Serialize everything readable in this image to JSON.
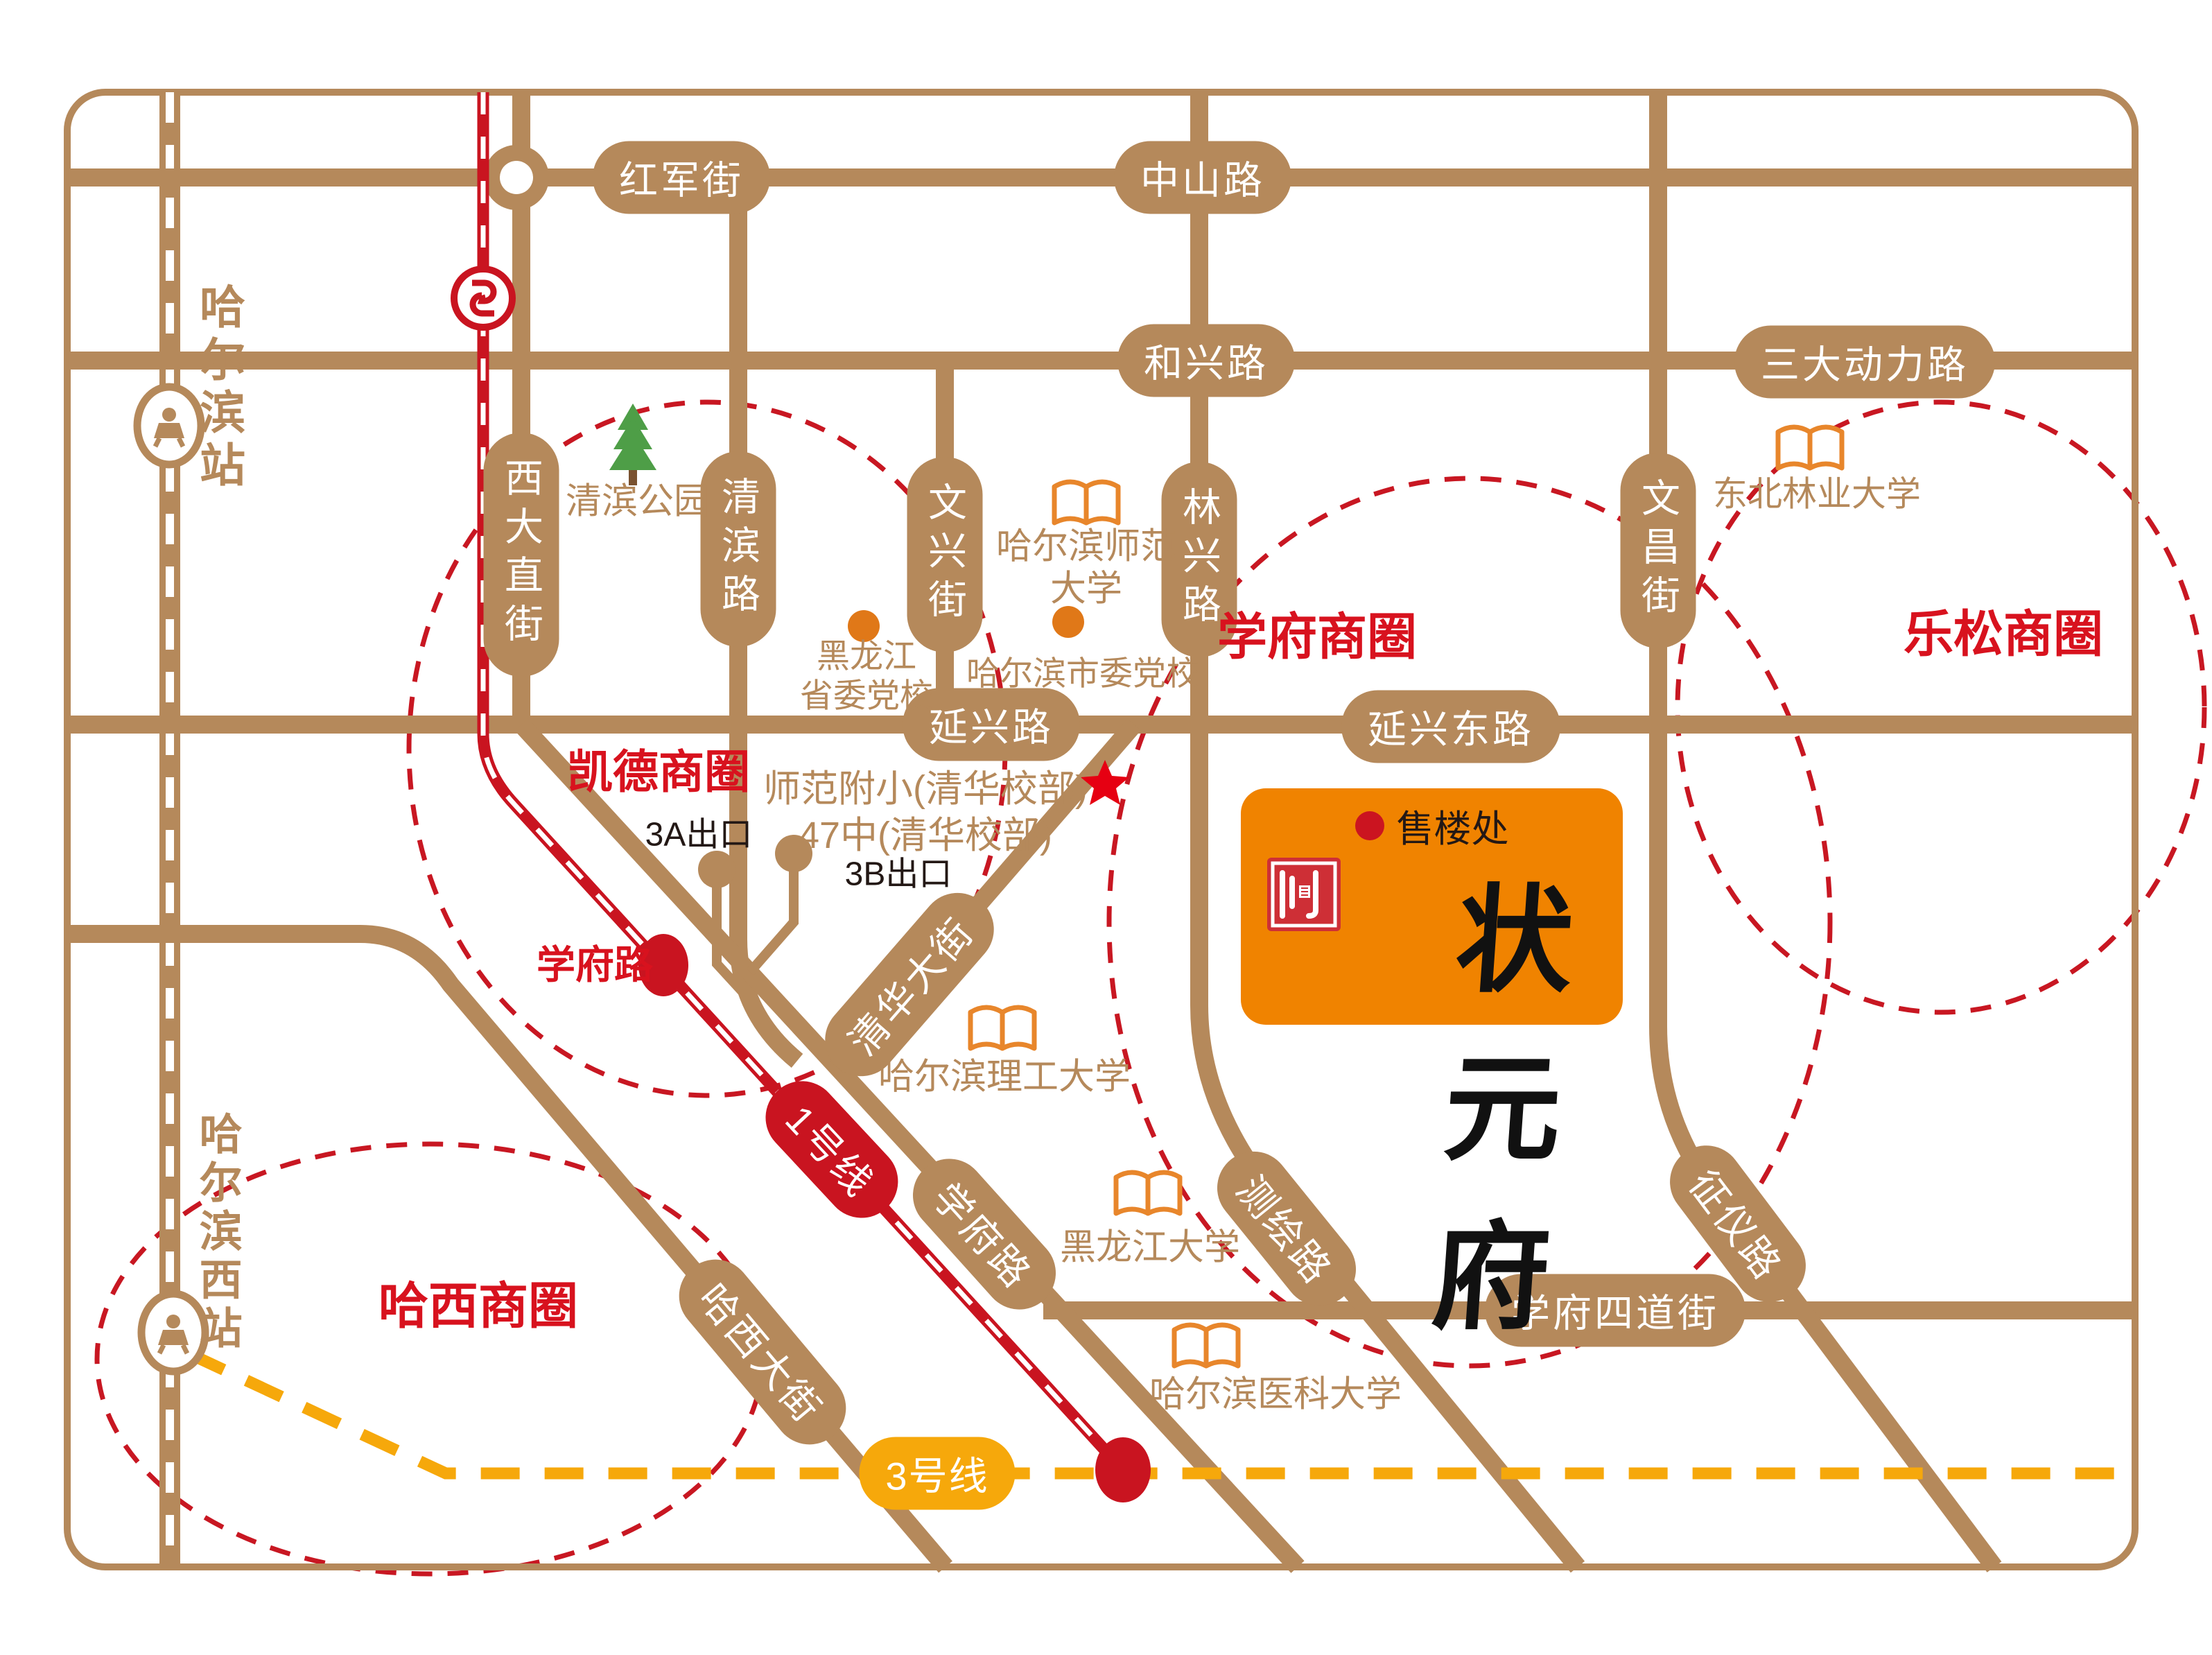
{
  "map_title": "状元府 区位示意图",
  "colors": {
    "road": "#B5895B",
    "metro_line1_red": "#C91420",
    "metro_line3_yellow": "#F6A80B",
    "business_circle_red": "#D8121E",
    "project_orange": "#F08300",
    "book_icon_orange": "#E8862B",
    "tree_green": "#4E9E47"
  },
  "roads": {
    "hongjun": "红军街",
    "zhongshan": "中山路",
    "hexing": "和兴路",
    "sandadongli": "三大动力路",
    "yanxing": "延兴路",
    "yanxingdong": "延兴东路",
    "xuefusidao": "学府四道街",
    "xidazhi": "西大直街",
    "qingbinlu": "清滨路",
    "wenxing": "文兴街",
    "linxing": "林兴路",
    "wenchang": "文昌街",
    "qinghua": "清华大街",
    "xuefulu": "学府路",
    "cehui": "测绘路",
    "zhengyi": "征仪路",
    "haxidajie": "哈西大街"
  },
  "metro": {
    "line1": "1号线",
    "line3": "3号线",
    "exit_3a": "3A出口",
    "exit_3b": "3B出口",
    "xuefulu_station": "学府路"
  },
  "stations": {
    "harbin": "哈尔滨站",
    "harbin_west": "哈尔滨西站"
  },
  "districts": {
    "kaide": "凯德商圈",
    "xuefu": "学府商圈",
    "lesong": "乐松商圈",
    "haxi": "哈西商圈"
  },
  "places": {
    "qingbin_park": "清滨公园",
    "provincial_party_school": "黑龙江\n省委党校",
    "normal_university": "哈尔滨师范\n大学",
    "city_party_school": "哈尔滨市委党校",
    "forestry_university": "东北林业大学",
    "ligong_university": "哈尔滨理工大学",
    "heilongjiang_university": "黑龙江大学",
    "medical_university": "哈尔滨医科大学",
    "fuxiao_school": "师范附小(清华校部)",
    "no47_school": "47中(清华校部)"
  },
  "project": {
    "name": "状元府",
    "sales_office": "售楼处"
  }
}
